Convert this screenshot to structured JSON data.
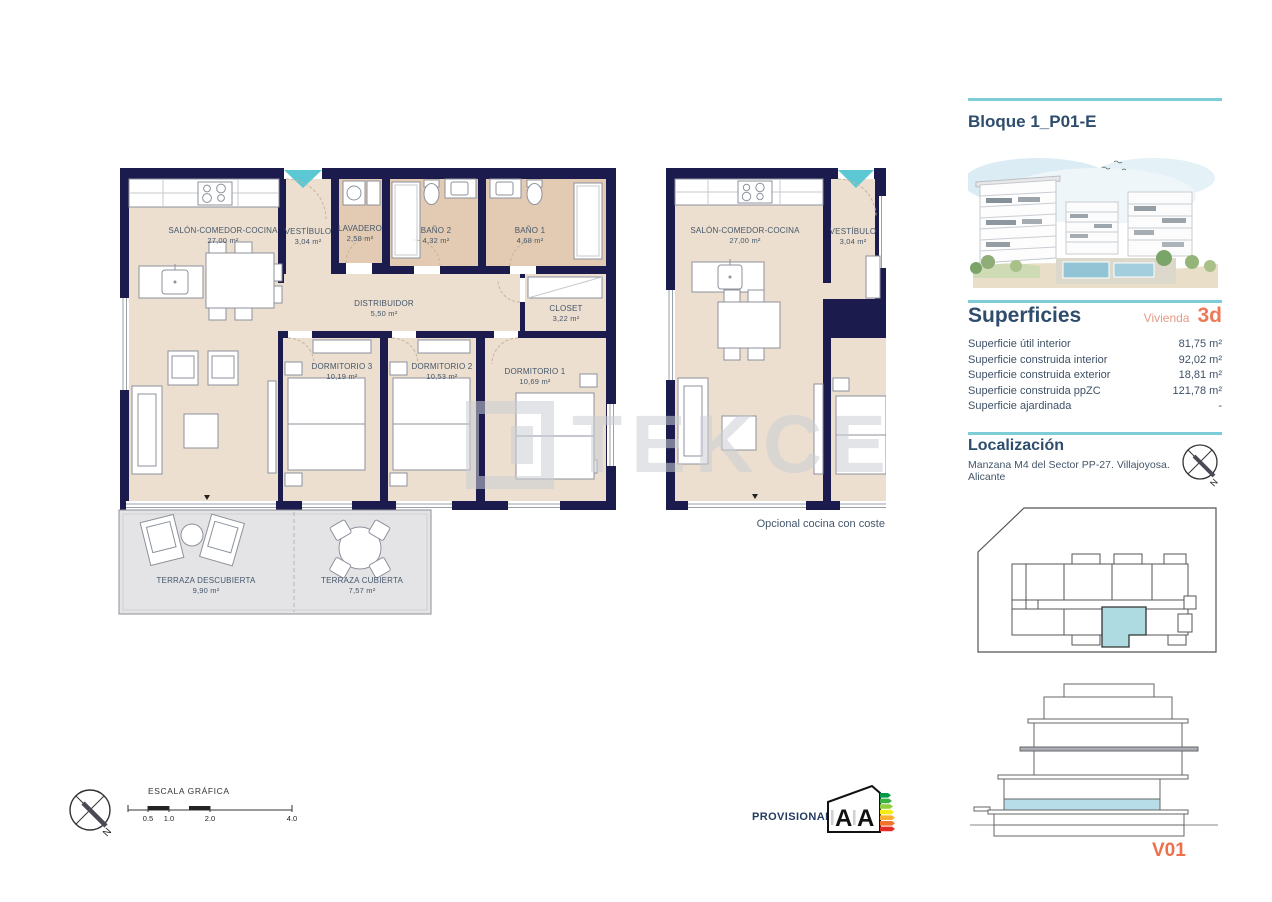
{
  "colors": {
    "wall": "#1b1b4d",
    "floor_beige": "#ecdfcf",
    "wet_room_tan": "#e3cab2",
    "terrace_gray": "#e4e4e6",
    "entrance_teal": "#5cc8d4",
    "divider_teal": "#7ccdd6",
    "heading_blue": "#2e4d6d",
    "coral_accent": "#ec7a58",
    "unit_highlight_blue": "#aedae2"
  },
  "watermark": "TEKCE",
  "compass_label": "N",
  "icons": {
    "entrance_marker": "teal-down-triangle",
    "north_arrow": "compass-cross-needle",
    "energy_rating": "house-energy-label"
  },
  "main_plan": {
    "rooms": [
      {
        "name": "SALÓN-COMEDOR-COCINA",
        "area": "27,00 m²"
      },
      {
        "name": "VESTÍBULO",
        "area": "3,04 m²"
      },
      {
        "name": "LAVADERO",
        "area": "2,58 m²"
      },
      {
        "name": "BAÑO 2",
        "area": "4,32 m²"
      },
      {
        "name": "BAÑO 1",
        "area": "4,68 m²"
      },
      {
        "name": "DISTRIBUIDOR",
        "area": "5,50 m²"
      },
      {
        "name": "CLOSET",
        "area": "3,22 m²"
      },
      {
        "name": "DORMITORIO 3",
        "area": "10,19 m²"
      },
      {
        "name": "DORMITORIO 2",
        "area": "10,53 m²"
      },
      {
        "name": "DORMITORIO 1",
        "area": "10,69 m²"
      },
      {
        "name": "TERRAZA DESCUBIERTA",
        "area": "9,90 m²"
      },
      {
        "name": "TERRAZA CUBIERTA",
        "area": "7,57 m²"
      }
    ]
  },
  "optional_plan": {
    "caption": "Opcional cocina con coste",
    "rooms": [
      {
        "name": "SALÓN-COMEDOR-COCINA",
        "area": "27,00 m²"
      },
      {
        "name": "VESTÍBULO",
        "area": "3,04 m²"
      }
    ]
  },
  "sidebar": {
    "title": "Bloque 1_P01-E",
    "superficies": {
      "heading": "Superficies",
      "unit_label": "Vivienda",
      "unit_value": "3d",
      "rows": [
        {
          "label": "Superficie útil interior",
          "value": "81,75 m²"
        },
        {
          "label": "Superficie construida interior",
          "value": "92,02 m²"
        },
        {
          "label": "Superficie construida exterior",
          "value": "18,81 m²"
        },
        {
          "label": "Superficie construida ppZC",
          "value": "121,78 m²"
        },
        {
          "label": "Superficie ajardinada",
          "value": "-"
        }
      ]
    },
    "localizacion": {
      "heading": "Localización",
      "address": "Manzana M4 del Sector PP-27. Villajoyosa. Alicante"
    },
    "version_label": "V01"
  },
  "footer": {
    "scale_title": "ESCALA GRÁFICA",
    "scale_ticks": [
      "0.5",
      "1.0",
      "2.0",
      "4.0"
    ],
    "provisional_label": "PROVISIONAL",
    "energy_letters": [
      "A",
      "A"
    ]
  }
}
